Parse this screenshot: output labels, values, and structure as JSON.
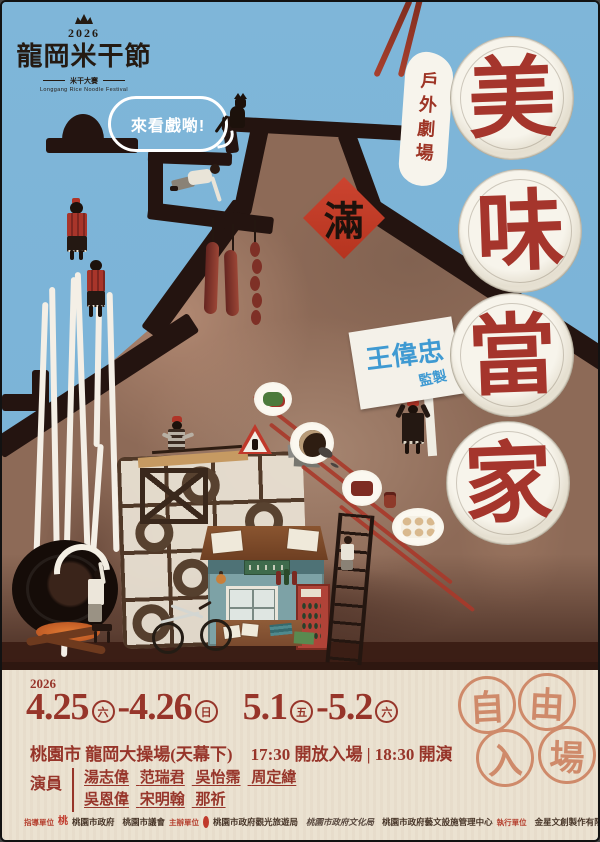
{
  "logo": {
    "year": "2026",
    "title": "龍岡米干節",
    "subtitle": "米干大賽",
    "subtitle_en": "Longgang Rice Noodle Festival"
  },
  "bubble": {
    "text": "來看戲喲!"
  },
  "outdoor_label": {
    "text": "戶外劇場"
  },
  "main_title": {
    "chars": [
      "美",
      "味",
      "當",
      "家"
    ]
  },
  "fu_diamond": {
    "char": "滿"
  },
  "producer_sign": {
    "name": "王偉忠",
    "role": "監製"
  },
  "info": {
    "year": "2026",
    "dates": {
      "d1": "4.25",
      "w1": "六",
      "dash": "-",
      "d2": "4.26",
      "w2": "日",
      "d3": "5.1",
      "w3": "五",
      "d4": "5.2",
      "w4": "六"
    },
    "venue": "桃園市 龍岡大操場(天幕下)",
    "time_open": "17:30 開放入場",
    "time_divider": "|",
    "time_start": "18:30 開演",
    "cast_label": "演員",
    "cast_line1": [
      "湯志偉",
      "范瑞君",
      "吳怡霈",
      "周定緯"
    ],
    "cast_line2": [
      "吳恩偉",
      "宋明翰",
      "那祈"
    ],
    "free_entry": [
      "自",
      "由",
      "入",
      "場"
    ]
  },
  "footer": {
    "groups": [
      {
        "role": "指導單位",
        "orgs": [
          "桃園市政府",
          "桃園市議會"
        ]
      },
      {
        "role": "主辦單位",
        "orgs": [
          "桃園市政府觀光旅遊局",
          "桃園市政府文化局",
          "桃園市政府藝文設施管理中心"
        ]
      },
      {
        "role": "執行單位",
        "orgs": [
          "金星文創製作有限公司"
        ]
      }
    ],
    "tao_glyph": "桃"
  },
  "colors": {
    "sky": "#7cb5da",
    "silhouette": "#241410",
    "mound": "#8d6a57",
    "title_red": "#a5352c",
    "diamond_red": "#c23b28",
    "cream": "#ebe2d1",
    "coral": "#cf8a6a",
    "sign_blue": "#3f9ad2",
    "text_red": "#97352a"
  }
}
